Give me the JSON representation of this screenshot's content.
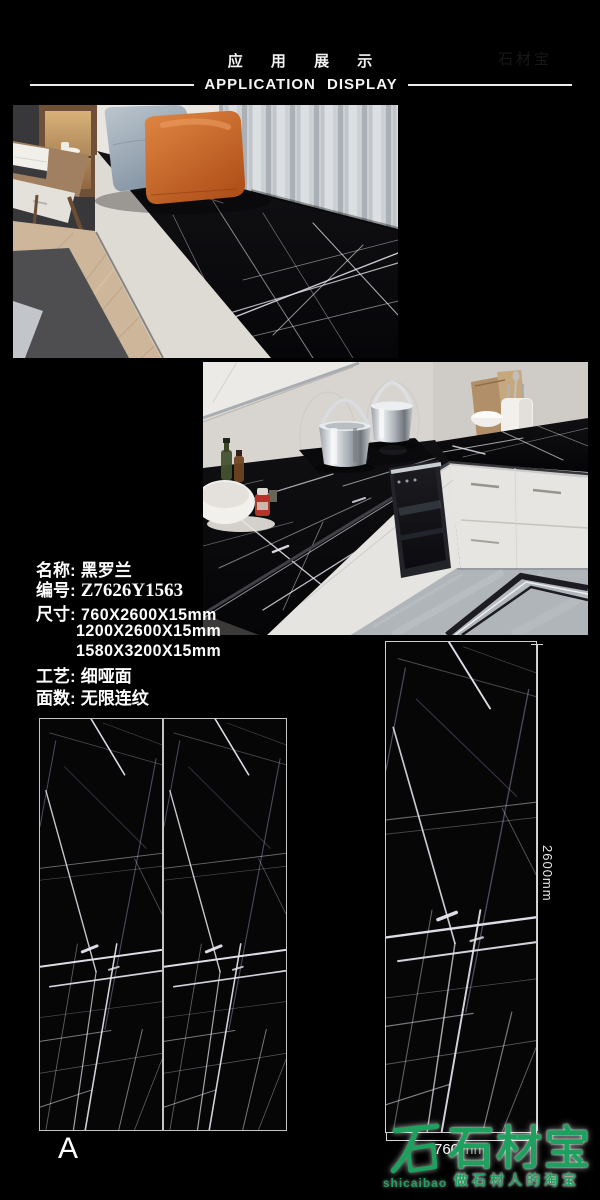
{
  "header": {
    "title_cn": "应 用 展 示",
    "title_en": "APPLICATION DISPLAY"
  },
  "specs": {
    "name_label": "名称:",
    "name_value": "黑罗兰",
    "code_label": "编号:",
    "code_value": "Z7626Y1563",
    "size_label": "尺寸:",
    "size_1": "760X2600X15mm",
    "size_2": "1200X2600X15mm",
    "size_3": "1580X3200X15mm",
    "finish_label": "工艺:",
    "finish_value": "细哑面",
    "pattern_label": "面数:",
    "pattern_value": "无限连纹"
  },
  "slabs": {
    "panel_label": "A",
    "height_dim": "2600mm",
    "width_dim_value": "760",
    "width_dim_unit": "mm"
  },
  "watermark": {
    "logo_latin": "shicaibao",
    "brand": "石材宝",
    "slogan": "做石材人的淘宝",
    "green": "#1fa05e"
  }
}
